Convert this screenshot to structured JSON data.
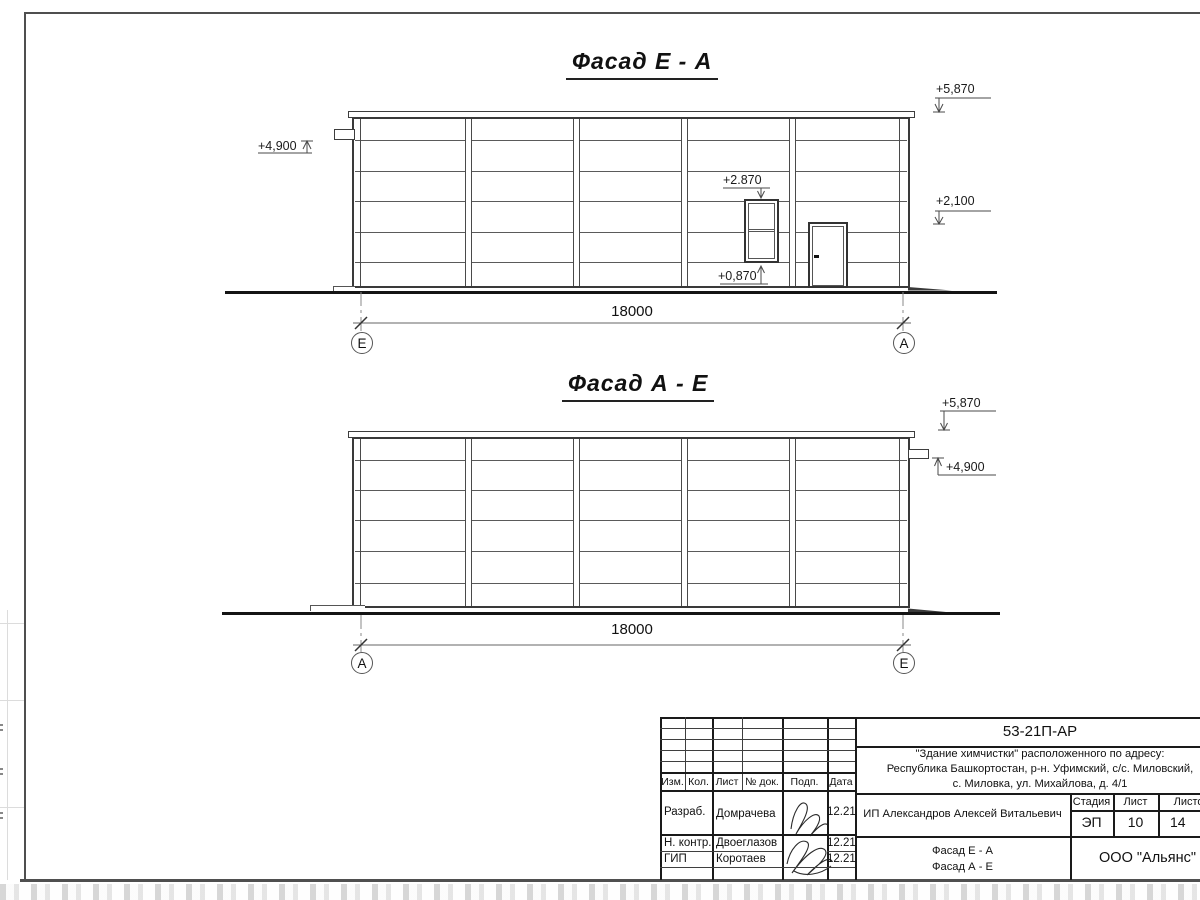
{
  "facade_ea": {
    "title": "Фасад Е - А",
    "dimension": "18000",
    "axis_left": "Е",
    "axis_right": "А",
    "mark_parapet": "+5,870",
    "mark_canopy": "+4,900",
    "mark_window_top": "+2.870",
    "mark_door_top": "+2,100",
    "mark_window_sill": "+0,870"
  },
  "facade_ae": {
    "title": "Фасад А - Е",
    "dimension": "18000",
    "axis_left": "А",
    "axis_right": "Е",
    "mark_parapet": "+5,870",
    "mark_canopy": "+4,900"
  },
  "title_block": {
    "doc_number": "53-21П-АР",
    "project_address_line1": "\"Здание химчистки\" расположенного по адресу:",
    "project_address_line2": "Республика Башкортостан, р-н. Уфимский, с/с. Миловский,",
    "project_address_line3": "с. Миловка, ул. Михайлова, д. 4/1",
    "header_cols": [
      "Изм.",
      "Кол.",
      "Лист",
      "№ док.",
      "Подп.",
      "Дата"
    ],
    "signers": [
      {
        "role": "Разраб.",
        "name": "Домрачева",
        "date": "12.21"
      },
      {
        "role": "Н. контр.",
        "name": "Двоеглазов",
        "date": "12.21"
      },
      {
        "role": "ГИП",
        "name": "Коротаев",
        "date": "12.21"
      }
    ],
    "client": "ИП Александров Алексей Витальевич",
    "stage_label": "Стадия",
    "sheet_label": "Лист",
    "sheets_label": "Листов",
    "stage": "ЭП",
    "sheet_number": "10",
    "sheets_total": "14",
    "drawing_title_line1": "Фасад Е - А",
    "drawing_title_line2": "Фасад А - Е",
    "company": "ООО \"Альянс\""
  }
}
